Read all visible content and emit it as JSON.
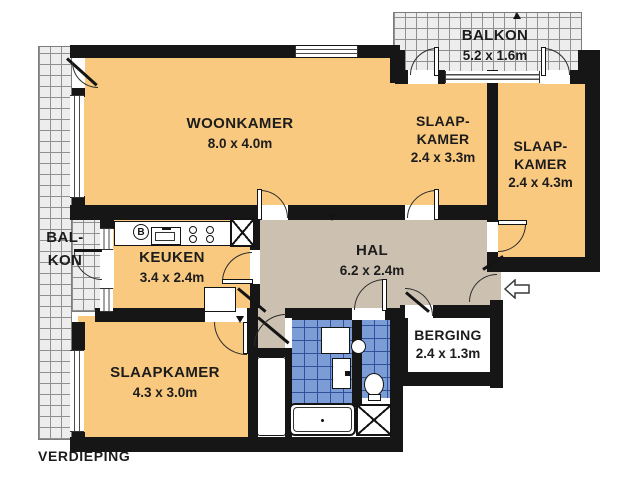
{
  "plan": {
    "floor_label": "VERDIEPING",
    "rooms": {
      "woonkamer": {
        "name": "WOONKAMER",
        "dims": "8.0 x 4.0m"
      },
      "balkon_top": {
        "name": "BALKON",
        "dims": "5.2 x 1.6m"
      },
      "slaapkamer_ne": {
        "name_line1": "SLAAP-",
        "name_line2": "KAMER",
        "dims": "2.4 x 3.3m"
      },
      "slaapkamer_e": {
        "name_line1": "SLAAP-",
        "name_line2": "KAMER",
        "dims": "2.4 x 4.3m"
      },
      "balkon_left": {
        "name_line1": "BAL-",
        "name_line2": "KON"
      },
      "keuken": {
        "name": "KEUKEN",
        "dims": "3.4 x 2.4m"
      },
      "hal": {
        "name": "HAL",
        "dims": "6.2 x 2.4m"
      },
      "berging": {
        "name": "BERGING",
        "dims": "2.4 x 1.3m"
      },
      "slaapkamer_sw": {
        "name": "SLAAPKAMER",
        "dims": "4.3 x 3.0m"
      }
    },
    "fixtures": {
      "boiler_label": "B"
    },
    "icons": {
      "entry_arrow": "left-arrow"
    },
    "colors": {
      "room_fill": "#F9C97F",
      "hall_fill": "#CCC1B1",
      "tile_fill": "#7B9CD5",
      "tile_line": "#30509C",
      "wall": "#161616",
      "balcony_fill": "#EDEDED"
    }
  }
}
